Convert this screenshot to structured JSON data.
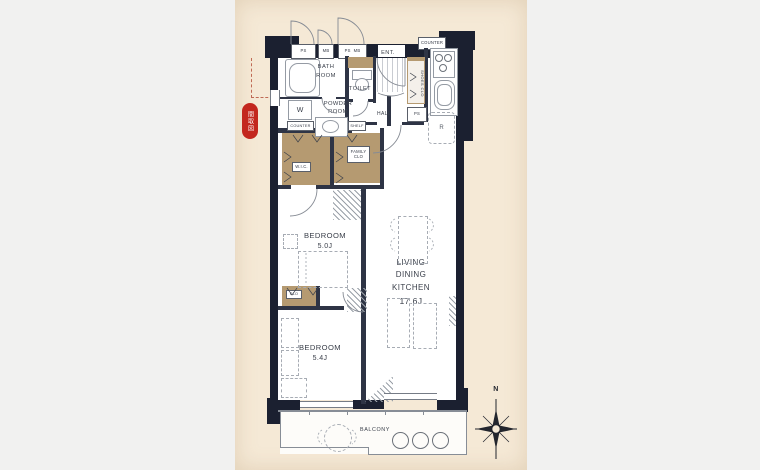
{
  "colors": {
    "canvas_bg": "#f1f1f0",
    "photo_bg": "#f5e9d6",
    "wall": "#1b2030",
    "closet": "#b59a71",
    "stamp_red": "#c3271e",
    "line_gray": "#9aa0a8",
    "text": "#3b404b"
  },
  "stamp": {
    "text": "間取図"
  },
  "tags": {
    "ps1": "PS",
    "mb1": "MB",
    "ps2": "PS",
    "mb2": "MB",
    "counter_top": "COUNTER",
    "counter_powder": "COUNTER",
    "shelf": "SHELF"
  },
  "rooms": {
    "bath": "BATH ROOM",
    "toilet": "TOILET",
    "powder": "POWDER ROOM",
    "ent": "ENT.",
    "hall": "HALL",
    "shoes_clo": "SHOES CLO",
    "ps": "PS",
    "wic": "W.I.C.",
    "family_clo": "FAMILY CLO",
    "clo": "CLO",
    "bedroom1_label": "BEDROOM",
    "bedroom1_size": "5.0J",
    "bedroom2_label": "BEDROOM",
    "bedroom2_size": "5.4J",
    "ldk_label": "LIVING\nDINING\nKITCHEN",
    "ldk_size": "17.6J",
    "balcony": "BALCONY"
  },
  "fixtures": {
    "washer": "W",
    "fridge": "R"
  },
  "compass": {
    "north": "N"
  }
}
